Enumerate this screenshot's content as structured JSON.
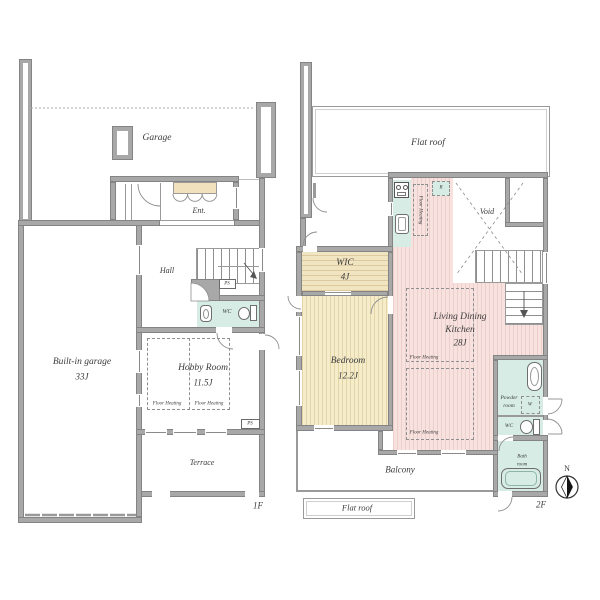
{
  "floor1": {
    "floor_label": "1F",
    "garage": "Garage",
    "ent": "Ent.",
    "hall": "Hall",
    "builtin_garage": {
      "name": "Built-in garage",
      "size": "33J"
    },
    "hobby_room": {
      "name": "Hobby Room",
      "size": "11.5J",
      "floor_heating_left": "Floor Heating",
      "floor_heating_right": "Floor Heating"
    },
    "wc": "WC",
    "terrace": "Terrace",
    "ps_upper": "PS",
    "ps_lower": "PS"
  },
  "floor2": {
    "floor_label": "2F",
    "flat_roof_top": "Flat roof",
    "flat_roof_bottom": "Flat roof",
    "wic": {
      "name": "WIC",
      "size": "4J"
    },
    "bedroom": {
      "name": "Bedroom",
      "size": "12.2J"
    },
    "ldk": {
      "name_line1": "Living Dining",
      "name_line2": "Kitchen",
      "size": "28J",
      "floor_heating_upper": "Floor Heating",
      "floor_heating_lower": "Floor Heating"
    },
    "kitchen": {
      "floor_heating": "Floor Heating",
      "fridge": "R"
    },
    "void": "Void",
    "powder_room": {
      "line1": "Powder",
      "line2": "room",
      "washer": "W"
    },
    "wc": "WC",
    "bath_room": {
      "line1": "Bath",
      "line2": "room"
    },
    "balcony": "Balcony",
    "compass_north": "N"
  },
  "colors": {
    "wall": "#a8a8a8",
    "wet_room_teal": "#d6ece5",
    "ldk_pink": "#f8e2df",
    "bedroom_tan": "#f5ecca",
    "wic_tan": "#f1e4c1",
    "cabinet_tan": "#f1e1bd",
    "line_gray": "#8f8f8f",
    "text": "#3b3b3b"
  }
}
